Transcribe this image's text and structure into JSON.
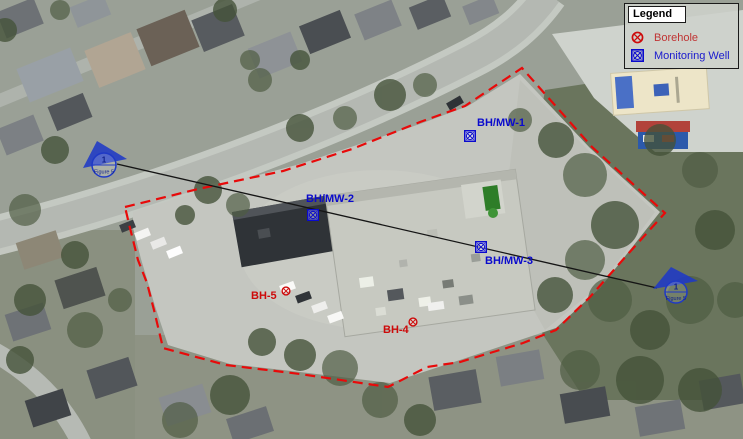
{
  "legend": {
    "title": "Legend",
    "items": [
      {
        "label": "Borehole",
        "icon": "borehole-icon",
        "color": "#cd0a0a"
      },
      {
        "label": "Monitoring Well",
        "icon": "monitoring-well-icon",
        "color": "#0a0acd"
      }
    ]
  },
  "map": {
    "monitoring_wells": [
      {
        "label": "BH/MW-1"
      },
      {
        "label": "BH/MW-2"
      },
      {
        "label": "BH/MW-3"
      }
    ],
    "boreholes": [
      {
        "label": "BH-5"
      },
      {
        "label": "BH-4"
      }
    ],
    "section_markers": [
      {
        "number": "1",
        "figure": "Figure 5",
        "position": "west-end"
      },
      {
        "number": "1",
        "figure": "Figure 5",
        "position": "east-end"
      }
    ],
    "colors": {
      "site_boundary": "#e80a0a",
      "section_line": "#151515",
      "borehole": "#cd0a0a",
      "monitoring_well": "#0a0acd",
      "section_marker": "#1f39c6"
    }
  }
}
